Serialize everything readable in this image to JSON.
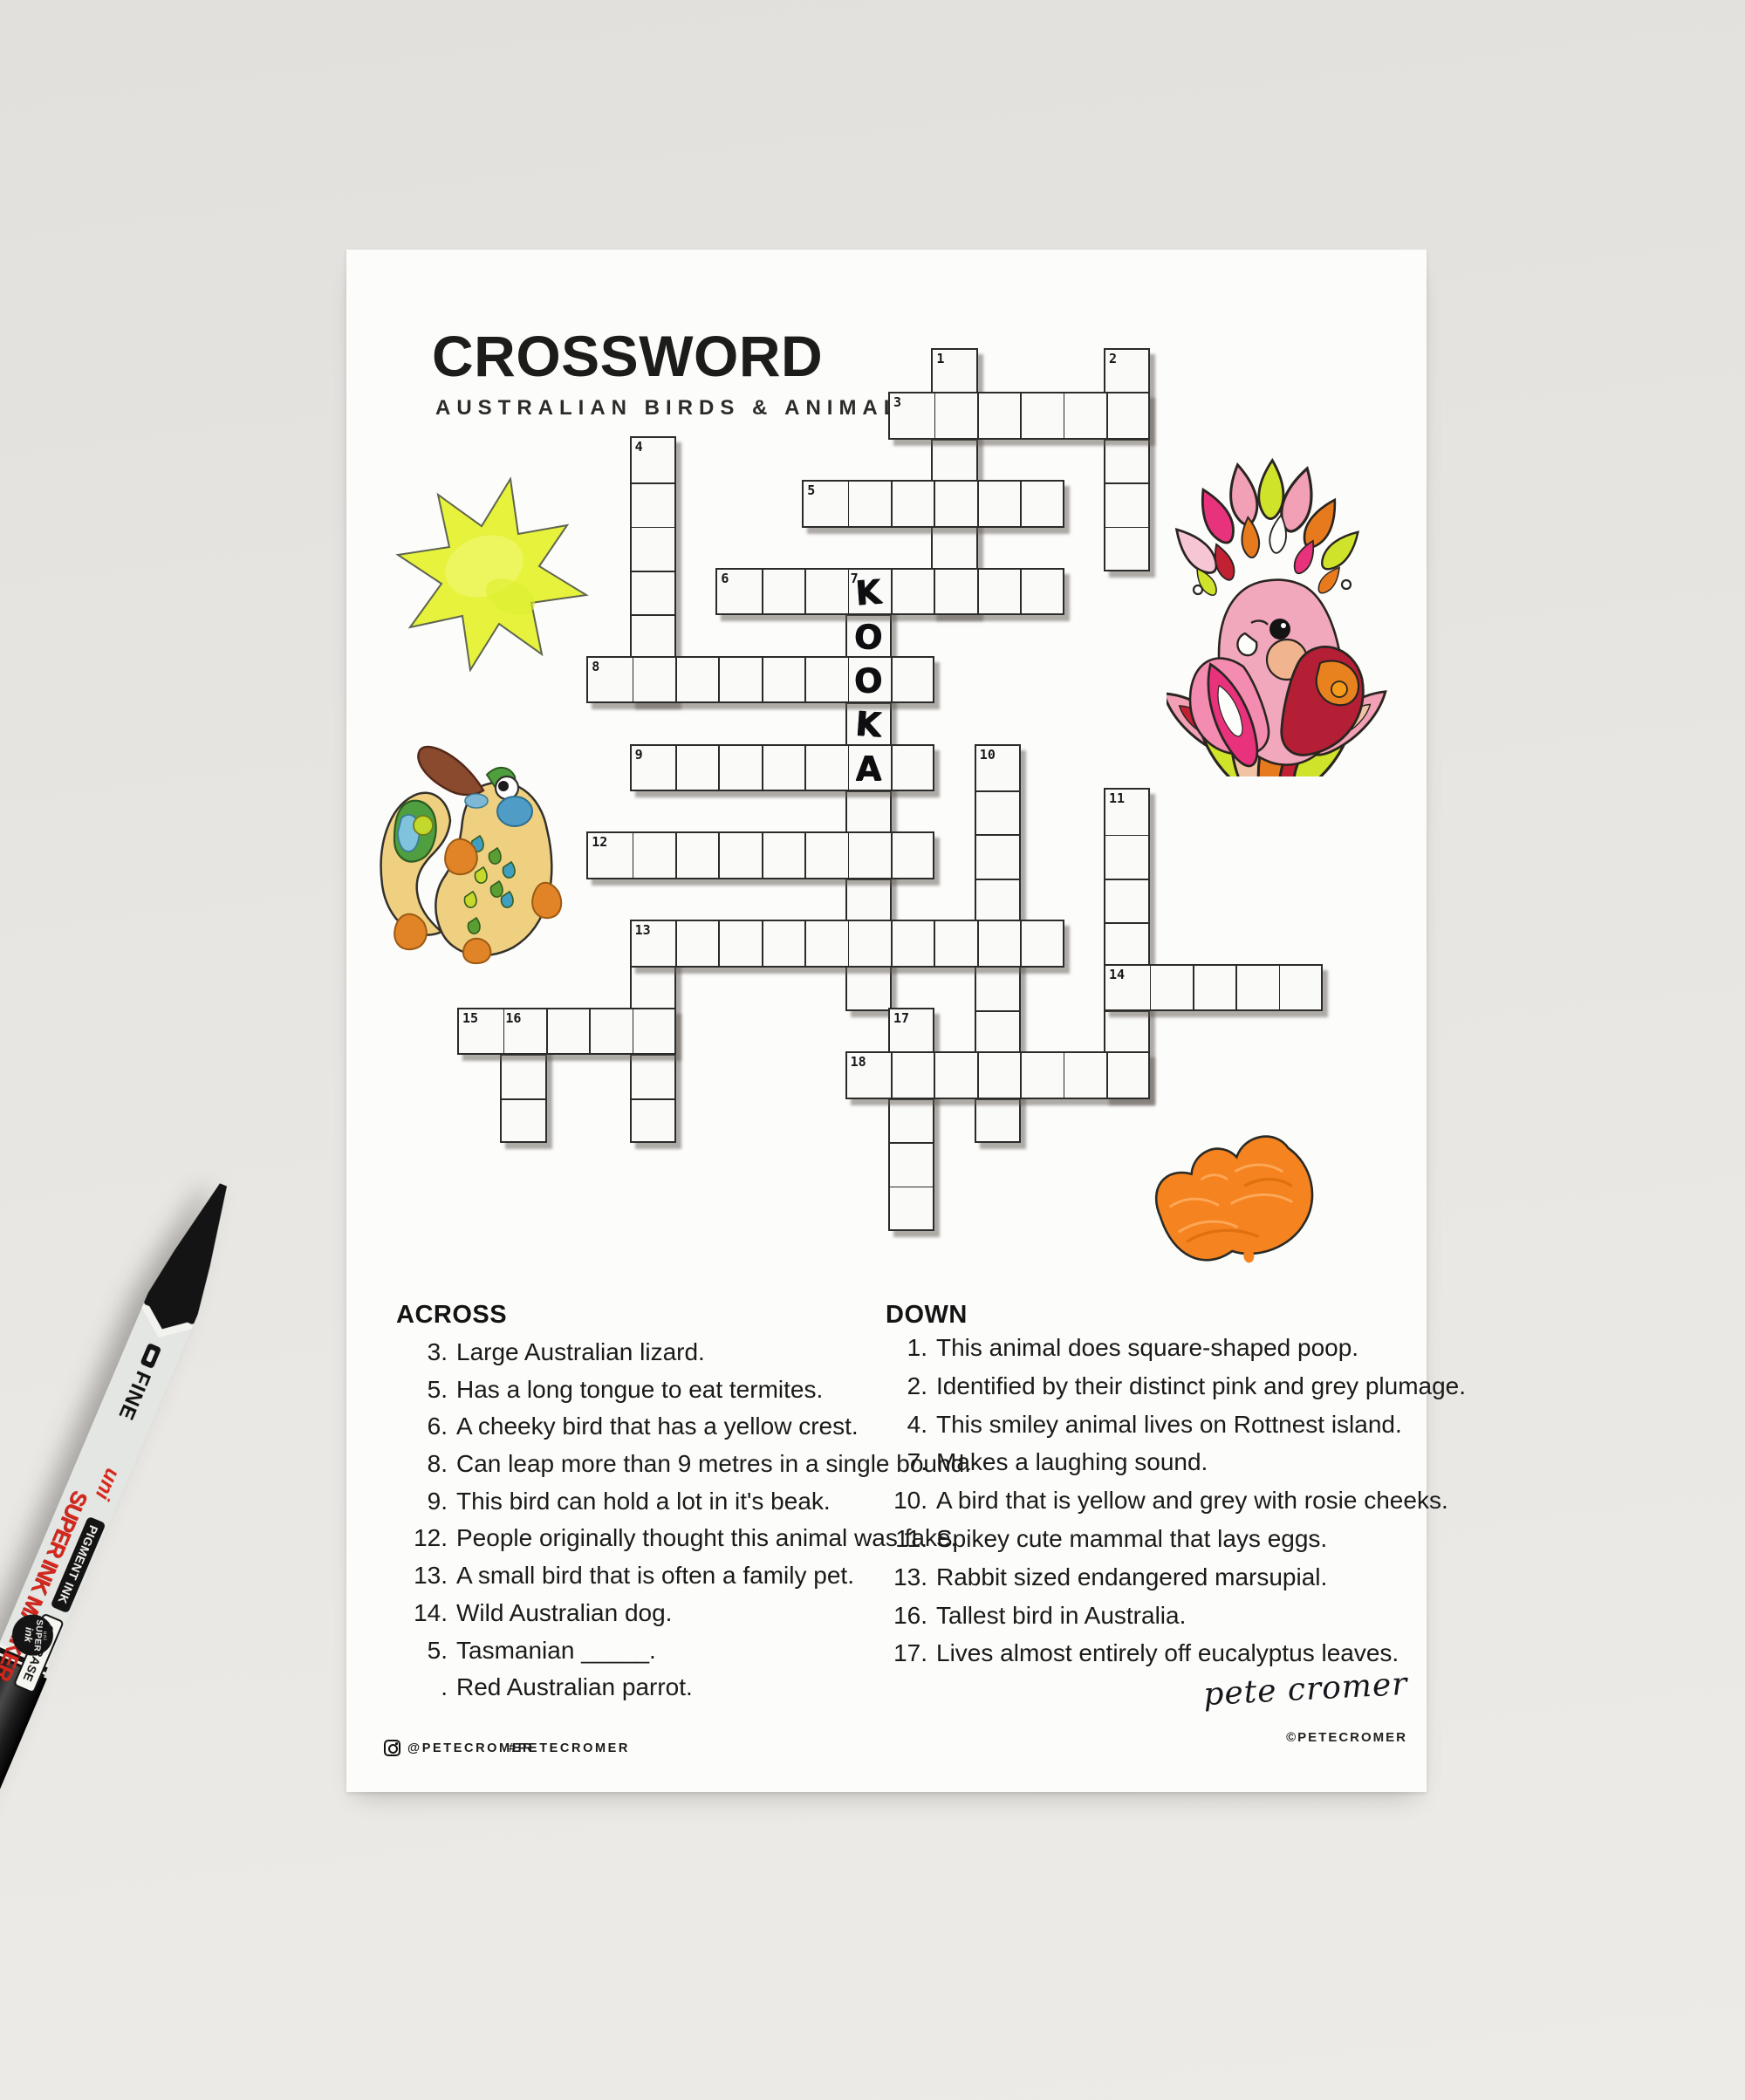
{
  "scene": {
    "desk_color": "#e7e5e1",
    "paper_color": "#fcfcfa"
  },
  "header": {
    "title": "CROSSWORD",
    "subtitle": "AUSTRALIAN BIRDS & ANIMALS"
  },
  "grid": {
    "rows": 20,
    "cols": 20,
    "words": [
      {
        "num": "1",
        "dir": "down",
        "row": 0,
        "col": 11,
        "len": 6
      },
      {
        "num": "2",
        "dir": "down",
        "row": 0,
        "col": 15,
        "len": 5
      },
      {
        "num": "3",
        "dir": "across",
        "row": 1,
        "col": 10,
        "len": 6
      },
      {
        "num": "4",
        "dir": "down",
        "row": 2,
        "col": 4,
        "len": 6
      },
      {
        "num": "5",
        "dir": "across",
        "row": 3,
        "col": 8,
        "len": 6
      },
      {
        "num": "6",
        "dir": "across",
        "row": 5,
        "col": 6,
        "len": 8
      },
      {
        "num": "7",
        "dir": "down",
        "row": 5,
        "col": 9,
        "len": 10
      },
      {
        "num": "8",
        "dir": "across",
        "row": 7,
        "col": 3,
        "len": 8
      },
      {
        "num": "9",
        "dir": "across",
        "row": 9,
        "col": 4,
        "len": 7
      },
      {
        "num": "10",
        "dir": "down",
        "row": 9,
        "col": 12,
        "len": 9
      },
      {
        "num": "11",
        "dir": "down",
        "row": 10,
        "col": 15,
        "len": 7
      },
      {
        "num": "12",
        "dir": "across",
        "row": 11,
        "col": 3,
        "len": 8
      },
      {
        "num": "13",
        "dir": "across",
        "row": 13,
        "col": 4,
        "len": 10
      },
      {
        "num": "13",
        "dir": "down",
        "row": 13,
        "col": 4,
        "len": 5
      },
      {
        "num": "14",
        "dir": "across",
        "row": 14,
        "col": 15,
        "len": 5
      },
      {
        "num": "15",
        "dir": "across",
        "row": 15,
        "col": 0,
        "len": 5
      },
      {
        "num": "16",
        "dir": "down",
        "row": 15,
        "col": 1,
        "len": 3
      },
      {
        "num": "17",
        "dir": "down",
        "row": 15,
        "col": 10,
        "len": 5
      },
      {
        "num": "18",
        "dir": "across",
        "row": 16,
        "col": 9,
        "len": 7
      }
    ],
    "numbers": [
      {
        "n": "1",
        "row": 0,
        "col": 11
      },
      {
        "n": "2",
        "row": 0,
        "col": 15
      },
      {
        "n": "3",
        "row": 1,
        "col": 10
      },
      {
        "n": "4",
        "row": 2,
        "col": 4
      },
      {
        "n": "5",
        "row": 3,
        "col": 8
      },
      {
        "n": "6",
        "row": 5,
        "col": 6
      },
      {
        "n": "7",
        "row": 5,
        "col": 9
      },
      {
        "n": "8",
        "row": 7,
        "col": 3
      },
      {
        "n": "9",
        "row": 9,
        "col": 4
      },
      {
        "n": "10",
        "row": 9,
        "col": 12
      },
      {
        "n": "11",
        "row": 10,
        "col": 15
      },
      {
        "n": "12",
        "row": 11,
        "col": 3
      },
      {
        "n": "13",
        "row": 13,
        "col": 4
      },
      {
        "n": "14",
        "row": 14,
        "col": 15
      },
      {
        "n": "15",
        "row": 15,
        "col": 0
      },
      {
        "n": "16",
        "row": 15,
        "col": 1
      },
      {
        "n": "17",
        "row": 15,
        "col": 10
      },
      {
        "n": "18",
        "row": 16,
        "col": 9
      }
    ],
    "filled_letters": [
      {
        "row": 5,
        "col": 9,
        "ch": "K"
      },
      {
        "row": 6,
        "col": 9,
        "ch": "O"
      },
      {
        "row": 7,
        "col": 9,
        "ch": "O"
      },
      {
        "row": 8,
        "col": 9,
        "ch": "K"
      },
      {
        "row": 9,
        "col": 9,
        "ch": "A"
      }
    ]
  },
  "clues": {
    "across_heading": "ACROSS",
    "down_heading": "DOWN",
    "across": [
      {
        "num": "3.",
        "text": "Large Australian lizard."
      },
      {
        "num": "5.",
        "text": "Has a long tongue to eat termites."
      },
      {
        "num": "6.",
        "text": "A cheeky bird that has a yellow crest."
      },
      {
        "num": "8.",
        "text": "Can leap more than 9 metres in a single bound."
      },
      {
        "num": "9.",
        "text": "This bird can hold a lot in it's beak."
      },
      {
        "num": "12.",
        "text": "People originally thought this animal was fake."
      },
      {
        "num": "13.",
        "text": "A small bird that is often a family pet."
      },
      {
        "num": "14.",
        "text": "Wild Australian dog."
      },
      {
        "num": "5.",
        "text": "Tasmanian _____."
      },
      {
        "num": ".",
        "text": "Red Australian parrot."
      }
    ],
    "down": [
      {
        "num": "1.",
        "text": "This animal does square-shaped poop."
      },
      {
        "num": "2.",
        "text": "Identified by their distinct pink and grey plumage."
      },
      {
        "num": "4.",
        "text": "This smiley animal lives on Rottnest island."
      },
      {
        "num": "7.",
        "text": "Makes a laughing sound."
      },
      {
        "num": "10.",
        "text": "A bird that is yellow and grey with rosie cheeks."
      },
      {
        "num": "11.",
        "text": "Spikey cute mammal that lays eggs."
      },
      {
        "num": "13.",
        "text": "Rabbit sized endangered marsupial."
      },
      {
        "num": "16.",
        "text": "Tallest bird in Australia."
      },
      {
        "num": "17.",
        "text": "Lives almost entirely off eucalyptus leaves."
      }
    ]
  },
  "pen": {
    "tip_label": "FINE",
    "brand": "uni",
    "product": "SUPER INK MARKER",
    "ink_type": "PIGMENT INK",
    "base": "OIL-BASE",
    "badge_brand": "uni",
    "badge_line1": "SUPER",
    "badge_line2": "ink"
  },
  "footer": {
    "instagram_handle": "@PETECROMER",
    "hashtag": "#PETECROMER",
    "signature": "pete cromer",
    "copyright": "©PETECROMER"
  },
  "illustrations": {
    "starburst": {
      "fill": "#e6f23c"
    },
    "platypus": {
      "body": "#efcf80",
      "bill": "#8a4a2e",
      "cheek": "#4f9cc6",
      "feet": "#e08427"
    },
    "galah": {
      "body": "#f2a8bc",
      "wing_left": "#f48bb0",
      "wing_right": "#b51f35",
      "accent_orange": "#e8821e",
      "accent_yellow": "#cfe32a",
      "accent_magenta": "#e8327c"
    },
    "blossom": {
      "fill": "#f5831f"
    }
  }
}
